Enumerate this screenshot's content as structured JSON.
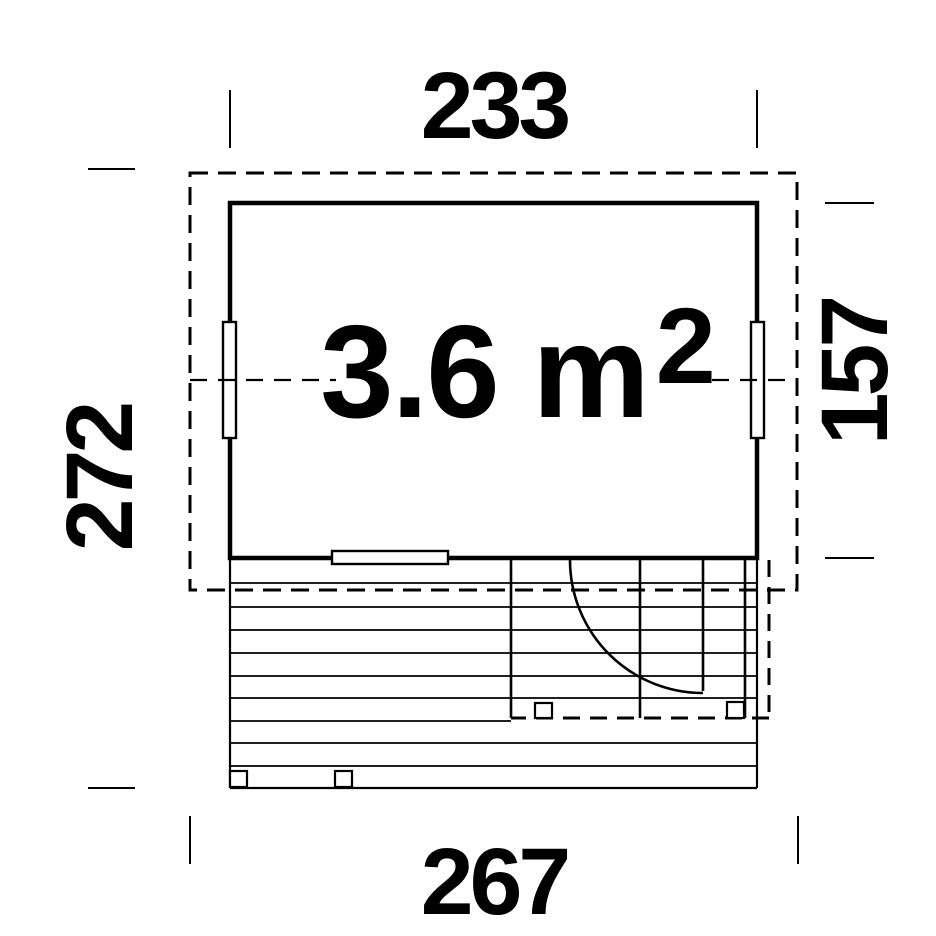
{
  "diagram": {
    "area": {
      "value": "3.6 m",
      "exponent": "2"
    },
    "dimensions": {
      "top": "233",
      "bottom": "267",
      "left": "272",
      "right": "157"
    },
    "colors": {
      "line": "#000000",
      "background": "#ffffff"
    }
  }
}
